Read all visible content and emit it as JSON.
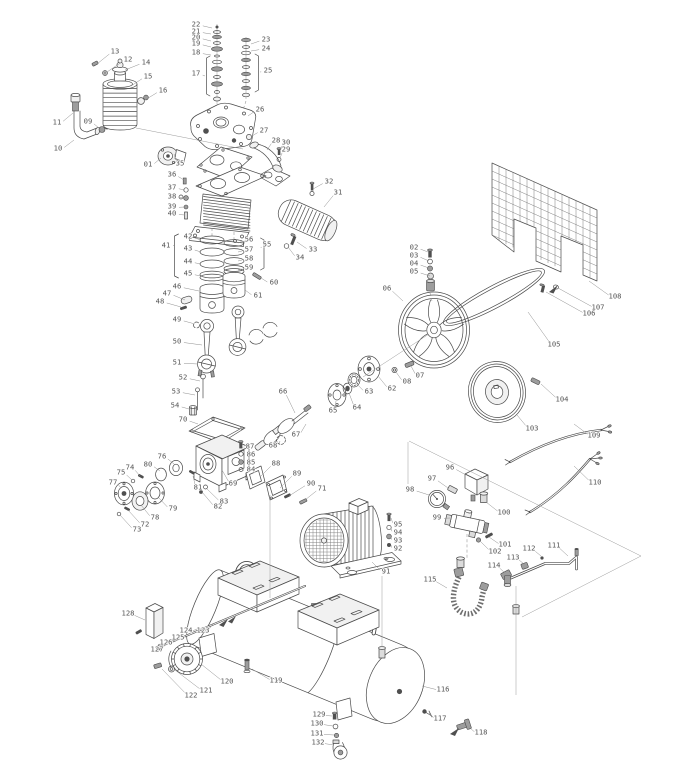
{
  "diagram": {
    "kind": "exploded-parts-diagram",
    "subject": "belt-driven air compressor",
    "colors": {
      "line": "#4a4a4a",
      "label": "#555555",
      "background": "#ffffff",
      "leader": "#8f8f8f"
    },
    "label_font_px": 7.2
  },
  "parts": [
    {
      "n": "01",
      "x": 148,
      "y": 164,
      "tx": 161,
      "ty": 158
    },
    {
      "n": "02",
      "x": 414,
      "y": 247,
      "tx": 428,
      "ty": 252
    },
    {
      "n": "03",
      "x": 414,
      "y": 255,
      "tx": 429,
      "ty": 261
    },
    {
      "n": "04",
      "x": 414,
      "y": 263,
      "tx": 429,
      "ty": 268
    },
    {
      "n": "05",
      "x": 414,
      "y": 271,
      "tx": 430,
      "ty": 276
    },
    {
      "n": "06",
      "x": 387,
      "y": 288,
      "tx": 403,
      "ty": 301
    },
    {
      "n": "07",
      "x": 420,
      "y": 375,
      "tx": 411,
      "ty": 366
    },
    {
      "n": "08",
      "x": 407,
      "y": 381,
      "tx": 396,
      "ty": 372
    },
    {
      "n": "09",
      "x": 88,
      "y": 121,
      "tx": 99,
      "ty": 128
    },
    {
      "n": "10",
      "x": 58,
      "y": 148,
      "tx": 74,
      "ty": 140
    },
    {
      "n": "11",
      "x": 57,
      "y": 122,
      "tx": 73,
      "ty": 113
    },
    {
      "n": "12",
      "x": 128,
      "y": 59,
      "tx": 107,
      "ty": 72
    },
    {
      "n": "13",
      "x": 115,
      "y": 51,
      "tx": 97,
      "ty": 64
    },
    {
      "n": "14",
      "x": 146,
      "y": 62,
      "tx": 125,
      "ty": 70
    },
    {
      "n": "15",
      "x": 148,
      "y": 76,
      "tx": 131,
      "ty": 86
    },
    {
      "n": "16",
      "x": 163,
      "y": 90,
      "tx": 145,
      "ty": 100
    },
    {
      "n": "17",
      "x": 196,
      "y": 73,
      "tx": 205,
      "ty": 76
    },
    {
      "n": "18",
      "x": 196,
      "y": 52,
      "tx": 211,
      "ty": 55
    },
    {
      "n": "19",
      "x": 196,
      "y": 43,
      "tx": 211,
      "ty": 47
    },
    {
      "n": "20",
      "x": 196,
      "y": 37,
      "tx": 211,
      "ty": 41
    },
    {
      "n": "21",
      "x": 196,
      "y": 31,
      "tx": 211,
      "ty": 34
    },
    {
      "n": "22",
      "x": 196,
      "y": 24,
      "tx": 212,
      "ty": 28
    },
    {
      "n": "23",
      "x": 266,
      "y": 39,
      "tx": 251,
      "ty": 44
    },
    {
      "n": "24",
      "x": 266,
      "y": 48,
      "tx": 251,
      "ty": 51
    },
    {
      "n": "25",
      "x": 268,
      "y": 70,
      "tx": 260,
      "ty": 72
    },
    {
      "n": "26",
      "x": 260,
      "y": 109,
      "tx": 248,
      "ty": 116
    },
    {
      "n": "27",
      "x": 264,
      "y": 130,
      "tx": 252,
      "ty": 136
    },
    {
      "n": "28",
      "x": 276,
      "y": 140,
      "tx": 267,
      "ty": 150
    },
    {
      "n": "29",
      "x": 286,
      "y": 149,
      "tx": 280,
      "ty": 158
    },
    {
      "n": "30",
      "x": 286,
      "y": 142,
      "tx": 280,
      "ty": 151
    },
    {
      "n": "31",
      "x": 338,
      "y": 192,
      "tx": 324,
      "ty": 207
    },
    {
      "n": "32",
      "x": 329,
      "y": 181,
      "tx": 313,
      "ty": 189
    },
    {
      "n": "33",
      "x": 313,
      "y": 249,
      "tx": 297,
      "ty": 242
    },
    {
      "n": "34",
      "x": 300,
      "y": 257,
      "tx": 288,
      "ty": 247
    },
    {
      "n": "35",
      "x": 180,
      "y": 163,
      "tx": 174,
      "ty": 154
    },
    {
      "n": "36",
      "x": 172,
      "y": 174,
      "tx": 184,
      "ty": 180
    },
    {
      "n": "37",
      "x": 172,
      "y": 187,
      "tx": 185,
      "ty": 190
    },
    {
      "n": "38",
      "x": 172,
      "y": 196,
      "tx": 185,
      "ty": 198
    },
    {
      "n": "39",
      "x": 172,
      "y": 206,
      "tx": 185,
      "ty": 207
    },
    {
      "n": "40",
      "x": 172,
      "y": 213,
      "tx": 185,
      "ty": 215
    },
    {
      "n": "41",
      "x": 166,
      "y": 245,
      "tx": 174,
      "ty": 245
    },
    {
      "n": "42",
      "x": 188,
      "y": 236,
      "tx": 201,
      "ty": 240
    },
    {
      "n": "43",
      "x": 188,
      "y": 248,
      "tx": 201,
      "ty": 252
    },
    {
      "n": "44",
      "x": 188,
      "y": 261,
      "tx": 201,
      "ty": 264
    },
    {
      "n": "45",
      "x": 188,
      "y": 273,
      "tx": 201,
      "ty": 276
    },
    {
      "n": "46",
      "x": 177,
      "y": 286,
      "tx": 199,
      "ty": 291
    },
    {
      "n": "47",
      "x": 167,
      "y": 293,
      "tx": 185,
      "ty": 300
    },
    {
      "n": "48",
      "x": 160,
      "y": 301,
      "tx": 181,
      "ty": 307
    },
    {
      "n": "49",
      "x": 177,
      "y": 319,
      "tx": 195,
      "ty": 324
    },
    {
      "n": "50",
      "x": 177,
      "y": 341,
      "tx": 202,
      "ty": 345
    },
    {
      "n": "51",
      "x": 177,
      "y": 362,
      "tx": 198,
      "ty": 364
    },
    {
      "n": "52",
      "x": 183,
      "y": 377,
      "tx": 200,
      "ty": 381
    },
    {
      "n": "53",
      "x": 176,
      "y": 391,
      "tx": 195,
      "ty": 395
    },
    {
      "n": "54",
      "x": 175,
      "y": 405,
      "tx": 189,
      "ty": 409
    },
    {
      "n": "55",
      "x": 267,
      "y": 244,
      "tx": 261,
      "ty": 248
    },
    {
      "n": "56",
      "x": 249,
      "y": 239,
      "tx": 238,
      "ty": 243
    },
    {
      "n": "57",
      "x": 249,
      "y": 249,
      "tx": 238,
      "ty": 252
    },
    {
      "n": "58",
      "x": 249,
      "y": 258,
      "tx": 238,
      "ty": 261
    },
    {
      "n": "59",
      "x": 249,
      "y": 267,
      "tx": 238,
      "ty": 270
    },
    {
      "n": "60",
      "x": 274,
      "y": 282,
      "tx": 261,
      "ty": 278
    },
    {
      "n": "61",
      "x": 258,
      "y": 295,
      "tx": 245,
      "ty": 290
    },
    {
      "n": "62",
      "x": 392,
      "y": 388,
      "tx": 378,
      "ty": 376
    },
    {
      "n": "63",
      "x": 369,
      "y": 391,
      "tx": 357,
      "ty": 384
    },
    {
      "n": "64",
      "x": 357,
      "y": 407,
      "tx": 349,
      "ty": 393
    },
    {
      "n": "65",
      "x": 333,
      "y": 410,
      "tx": 336,
      "ty": 401
    },
    {
      "n": "66",
      "x": 283,
      "y": 391,
      "tx": 295,
      "ty": 413
    },
    {
      "n": "67",
      "x": 296,
      "y": 434,
      "tx": 306,
      "ty": 424
    },
    {
      "n": "68",
      "x": 273,
      "y": 445,
      "tx": 280,
      "ty": 441
    },
    {
      "n": "69",
      "x": 233,
      "y": 483,
      "tx": 222,
      "ty": 470
    },
    {
      "n": "70",
      "x": 183,
      "y": 419,
      "tx": 198,
      "ty": 424
    },
    {
      "n": "71",
      "x": 322,
      "y": 488,
      "tx": 305,
      "ty": 500
    },
    {
      "n": "72",
      "x": 145,
      "y": 524,
      "tx": 128,
      "ty": 510
    },
    {
      "n": "73",
      "x": 137,
      "y": 529,
      "tx": 120,
      "ty": 515
    },
    {
      "n": "74",
      "x": 130,
      "y": 467,
      "tx": 140,
      "ty": 476
    },
    {
      "n": "75",
      "x": 121,
      "y": 472,
      "tx": 132,
      "ty": 480
    },
    {
      "n": "76",
      "x": 162,
      "y": 456,
      "tx": 174,
      "ty": 464
    },
    {
      "n": "77",
      "x": 113,
      "y": 482,
      "tx": 121,
      "ty": 488
    },
    {
      "n": "78",
      "x": 155,
      "y": 517,
      "tx": 141,
      "ty": 505
    },
    {
      "n": "79",
      "x": 173,
      "y": 508,
      "tx": 158,
      "ty": 497
    },
    {
      "n": "80",
      "x": 148,
      "y": 464,
      "tx": 160,
      "ty": 471
    },
    {
      "n": "81",
      "x": 198,
      "y": 487,
      "tx": 193,
      "ty": 476
    },
    {
      "n": "82",
      "x": 218,
      "y": 506,
      "tx": 202,
      "ty": 492
    },
    {
      "n": "83",
      "x": 224,
      "y": 501,
      "tx": 206,
      "ty": 488
    },
    {
      "n": "84",
      "x": 251,
      "y": 469,
      "tx": 243,
      "ty": 470
    },
    {
      "n": "85",
      "x": 251,
      "y": 462,
      "tx": 243,
      "ty": 463
    },
    {
      "n": "86",
      "x": 251,
      "y": 454,
      "tx": 243,
      "ty": 455
    },
    {
      "n": "87",
      "x": 250,
      "y": 446,
      "tx": 242,
      "ty": 447
    },
    {
      "n": "88",
      "x": 276,
      "y": 463,
      "tx": 261,
      "ty": 476
    },
    {
      "n": "89",
      "x": 297,
      "y": 473,
      "tx": 280,
      "ty": 488
    },
    {
      "n": "90",
      "x": 311,
      "y": 483,
      "tx": 289,
      "ty": 496
    },
    {
      "n": "91",
      "x": 386,
      "y": 571,
      "tx": 372,
      "ty": 562
    },
    {
      "n": "92",
      "x": 398,
      "y": 548,
      "tx": 391,
      "ty": 545
    },
    {
      "n": "93",
      "x": 398,
      "y": 540,
      "tx": 391,
      "ty": 537
    },
    {
      "n": "94",
      "x": 398,
      "y": 532,
      "tx": 391,
      "ty": 528
    },
    {
      "n": "95",
      "x": 398,
      "y": 524,
      "tx": 391,
      "ty": 518
    },
    {
      "n": "96",
      "x": 450,
      "y": 467,
      "tx": 466,
      "ty": 475
    },
    {
      "n": "97",
      "x": 432,
      "y": 478,
      "tx": 448,
      "ty": 488
    },
    {
      "n": "98",
      "x": 410,
      "y": 489,
      "tx": 429,
      "ty": 495
    },
    {
      "n": "99",
      "x": 437,
      "y": 517,
      "tx": 450,
      "ty": 518
    },
    {
      "n": "100",
      "x": 504,
      "y": 512,
      "tx": 486,
      "ty": 502
    },
    {
      "n": "101",
      "x": 505,
      "y": 544,
      "tx": 489,
      "ty": 537
    },
    {
      "n": "102",
      "x": 495,
      "y": 551,
      "tx": 480,
      "ty": 541
    },
    {
      "n": "103",
      "x": 532,
      "y": 428,
      "tx": 517,
      "ty": 415
    },
    {
      "n": "104",
      "x": 562,
      "y": 399,
      "tx": 541,
      "ty": 384
    },
    {
      "n": "105",
      "x": 554,
      "y": 344,
      "tx": 528,
      "ty": 312
    },
    {
      "n": "106",
      "x": 589,
      "y": 313,
      "tx": 546,
      "ty": 292
    },
    {
      "n": "107",
      "x": 598,
      "y": 307,
      "tx": 558,
      "ty": 288
    },
    {
      "n": "108",
      "x": 615,
      "y": 296,
      "tx": 589,
      "ty": 281
    },
    {
      "n": "109",
      "x": 594,
      "y": 435,
      "tx": 574,
      "ty": 424
    },
    {
      "n": "110",
      "x": 595,
      "y": 482,
      "tx": 574,
      "ty": 466
    },
    {
      "n": "111",
      "x": 554,
      "y": 545,
      "tx": 568,
      "ty": 556
    },
    {
      "n": "112",
      "x": 529,
      "y": 548,
      "tx": 541,
      "ty": 556
    },
    {
      "n": "113",
      "x": 513,
      "y": 557,
      "tx": 524,
      "ty": 564
    },
    {
      "n": "114",
      "x": 494,
      "y": 565,
      "tx": 505,
      "ty": 573
    },
    {
      "n": "115",
      "x": 430,
      "y": 579,
      "tx": 447,
      "ty": 588
    },
    {
      "n": "116",
      "x": 443,
      "y": 689,
      "tx": 422,
      "ty": 686
    },
    {
      "n": "117",
      "x": 440,
      "y": 718,
      "tx": 429,
      "ty": 713
    },
    {
      "n": "118",
      "x": 481,
      "y": 732,
      "tx": 470,
      "ty": 728
    },
    {
      "n": "119",
      "x": 276,
      "y": 680,
      "tx": 252,
      "ty": 669
    },
    {
      "n": "120",
      "x": 227,
      "y": 681,
      "tx": 201,
      "ty": 664
    },
    {
      "n": "121",
      "x": 206,
      "y": 690,
      "tx": 175,
      "ty": 670
    },
    {
      "n": "122",
      "x": 191,
      "y": 695,
      "tx": 162,
      "ty": 669
    },
    {
      "n": "123",
      "x": 203,
      "y": 630,
      "tx": 213,
      "ty": 624
    },
    {
      "n": "124",
      "x": 186,
      "y": 630,
      "tx": 197,
      "ty": 629
    },
    {
      "n": "125",
      "x": 178,
      "y": 637,
      "tx": 187,
      "ty": 634
    },
    {
      "n": "126",
      "x": 166,
      "y": 642,
      "tx": 176,
      "ty": 639
    },
    {
      "n": "127",
      "x": 157,
      "y": 649,
      "tx": 166,
      "ty": 643
    },
    {
      "n": "128",
      "x": 128,
      "y": 613,
      "tx": 145,
      "ty": 620
    },
    {
      "n": "129",
      "x": 319,
      "y": 714,
      "tx": 332,
      "ty": 716
    },
    {
      "n": "130",
      "x": 317,
      "y": 723,
      "tx": 333,
      "ty": 726
    },
    {
      "n": "131",
      "x": 317,
      "y": 733,
      "tx": 334,
      "ty": 735
    },
    {
      "n": "132",
      "x": 318,
      "y": 742,
      "tx": 334,
      "ty": 745
    }
  ]
}
